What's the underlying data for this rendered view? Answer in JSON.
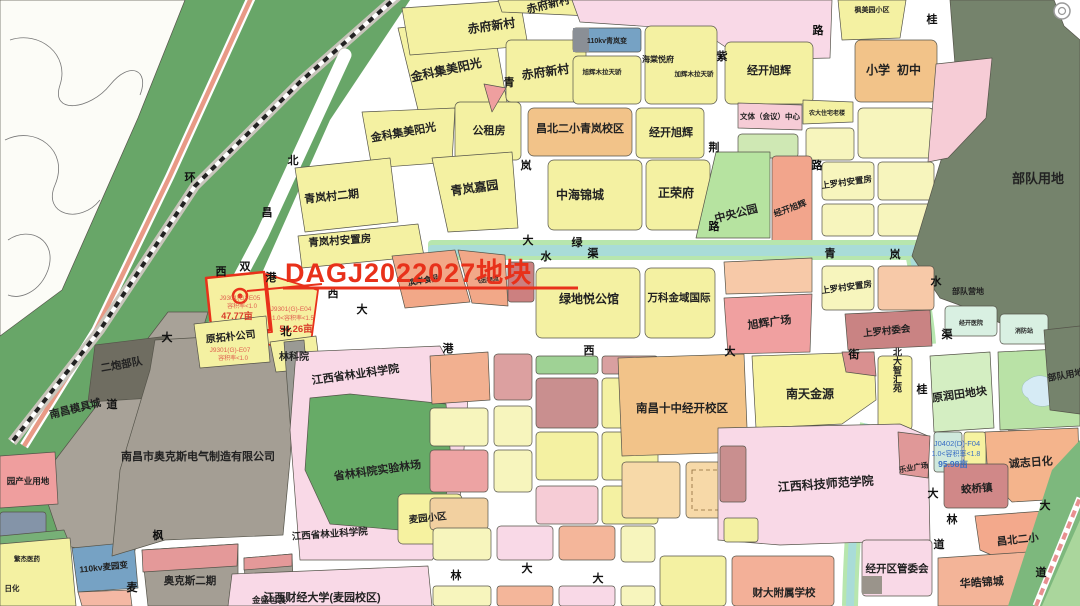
{
  "map": {
    "highlight": {
      "parcel_label": "DAGJ2022027地块",
      "color": "#e8311a"
    },
    "palette": {
      "residential_yellow": "#f4f1a2",
      "school_orange": "#f2c389",
      "commercial_salmon": "#f4b69a",
      "village_rose": "#dd9494",
      "institute_pink": "#f9d9e7",
      "park_green": "#b6e3a0",
      "forest_green": "#68a668",
      "military_olive": "#75836c",
      "industrial_gray": "#a49e94",
      "water_teal": "#a9dcd8",
      "substation_blue": "#76a2c4",
      "road_white": "#ffffff",
      "highlight_red": "#e8311a",
      "code_blue": "#3a6fc4",
      "code_red": "#e06050"
    },
    "labels": [
      {
        "t": "赤府新村"
      },
      {
        "t": "赤府新村"
      },
      {
        "t": "金科集美阳光"
      },
      {
        "t": "金科集美阳光"
      },
      {
        "t": "公租房"
      },
      {
        "t": "赤府新村"
      },
      {
        "t": "110kv青岚变"
      },
      {
        "t": "旭辉木拉天骄"
      },
      {
        "t": "海棠悦府"
      },
      {
        "t": "加辉木拉天骄"
      },
      {
        "t": "昌北二小青岚校区"
      },
      {
        "t": "经开旭辉"
      },
      {
        "t": "经开旭辉"
      },
      {
        "t": "小学"
      },
      {
        "t": "初中"
      },
      {
        "t": "枫美园小区"
      },
      {
        "t": "文体（会议）中心"
      },
      {
        "t": "农大住宅老楼"
      },
      {
        "t": "部队用地"
      },
      {
        "t": "青岚村二期"
      },
      {
        "t": "青岚村安置房"
      },
      {
        "t": "青岚嘉园"
      },
      {
        "t": "中海锦城"
      },
      {
        "t": "正荣府"
      },
      {
        "t": "中央公园"
      },
      {
        "t": "经开旭辉"
      },
      {
        "t": "上罗村安置房"
      },
      {
        "t": "上罗村安置房"
      },
      {
        "t": "上罗村委会"
      },
      {
        "t": "旭辉广场"
      },
      {
        "t": "万科金域国际"
      },
      {
        "t": "绿地悦公馆"
      },
      {
        "t": "滨岸食品"
      },
      {
        "t": "飞远物流"
      },
      {
        "t": "原拓朴公司"
      },
      {
        "t": "林科院"
      },
      {
        "t": "江西省林业科学院"
      },
      {
        "t": "省林科院实验林场"
      },
      {
        "t": "江西省林业科学院"
      },
      {
        "t": "麦园小区"
      },
      {
        "t": "江西财经大学(麦园校区)"
      },
      {
        "t": "南昌十中经开校区"
      },
      {
        "t": "南天金源"
      },
      {
        "t": "北大智汇苑"
      },
      {
        "t": "江西科技师范学院"
      },
      {
        "t": "乐业广场"
      },
      {
        "t": "蛟桥镇"
      },
      {
        "t": "诚志日化"
      },
      {
        "t": "原润田地块"
      },
      {
        "t": "部队用地"
      },
      {
        "t": "部队营地"
      },
      {
        "t": "昌北二小"
      },
      {
        "t": "华皓锦城"
      },
      {
        "t": "经开区管委会"
      },
      {
        "t": "财大附属学校"
      },
      {
        "t": "二炮部队"
      },
      {
        "t": "南昌模具城"
      },
      {
        "t": "园产业用地"
      },
      {
        "t": "南昌市奥克斯电气制造有限公司"
      },
      {
        "t": "110kv麦园变"
      },
      {
        "t": "奥克斯二期"
      },
      {
        "t": "金盛包装"
      },
      {
        "t": "繁杰医药"
      },
      {
        "t": "日化"
      },
      {
        "t": "经开医院"
      },
      {
        "t": "消防站"
      }
    ],
    "codes": [
      "J9301(G)-E05",
      "容积率<1.0",
      "47.77亩",
      "J9301(G)-E04",
      "1.0<容积率<1.5",
      "54.26亩",
      "J9301(G)-E07",
      "容积率<1.0",
      "J0402(D)-F04",
      "1.0<容积率<1.8",
      "95.98亩"
    ],
    "roadChars": [
      "环",
      "北",
      "昌",
      "双",
      "港",
      "西",
      "大",
      "道",
      "枫",
      "麦",
      "西",
      "大",
      "北",
      "青",
      "岚",
      "大",
      "港",
      "西",
      "大",
      "街",
      "绿",
      "水",
      "渠",
      "青",
      "岚",
      "水",
      "渠",
      "紫",
      "荆",
      "路",
      "路",
      "路",
      "桂",
      "桂",
      "林",
      "大",
      "大",
      "大",
      "林",
      "道",
      "大",
      "道"
    ]
  }
}
